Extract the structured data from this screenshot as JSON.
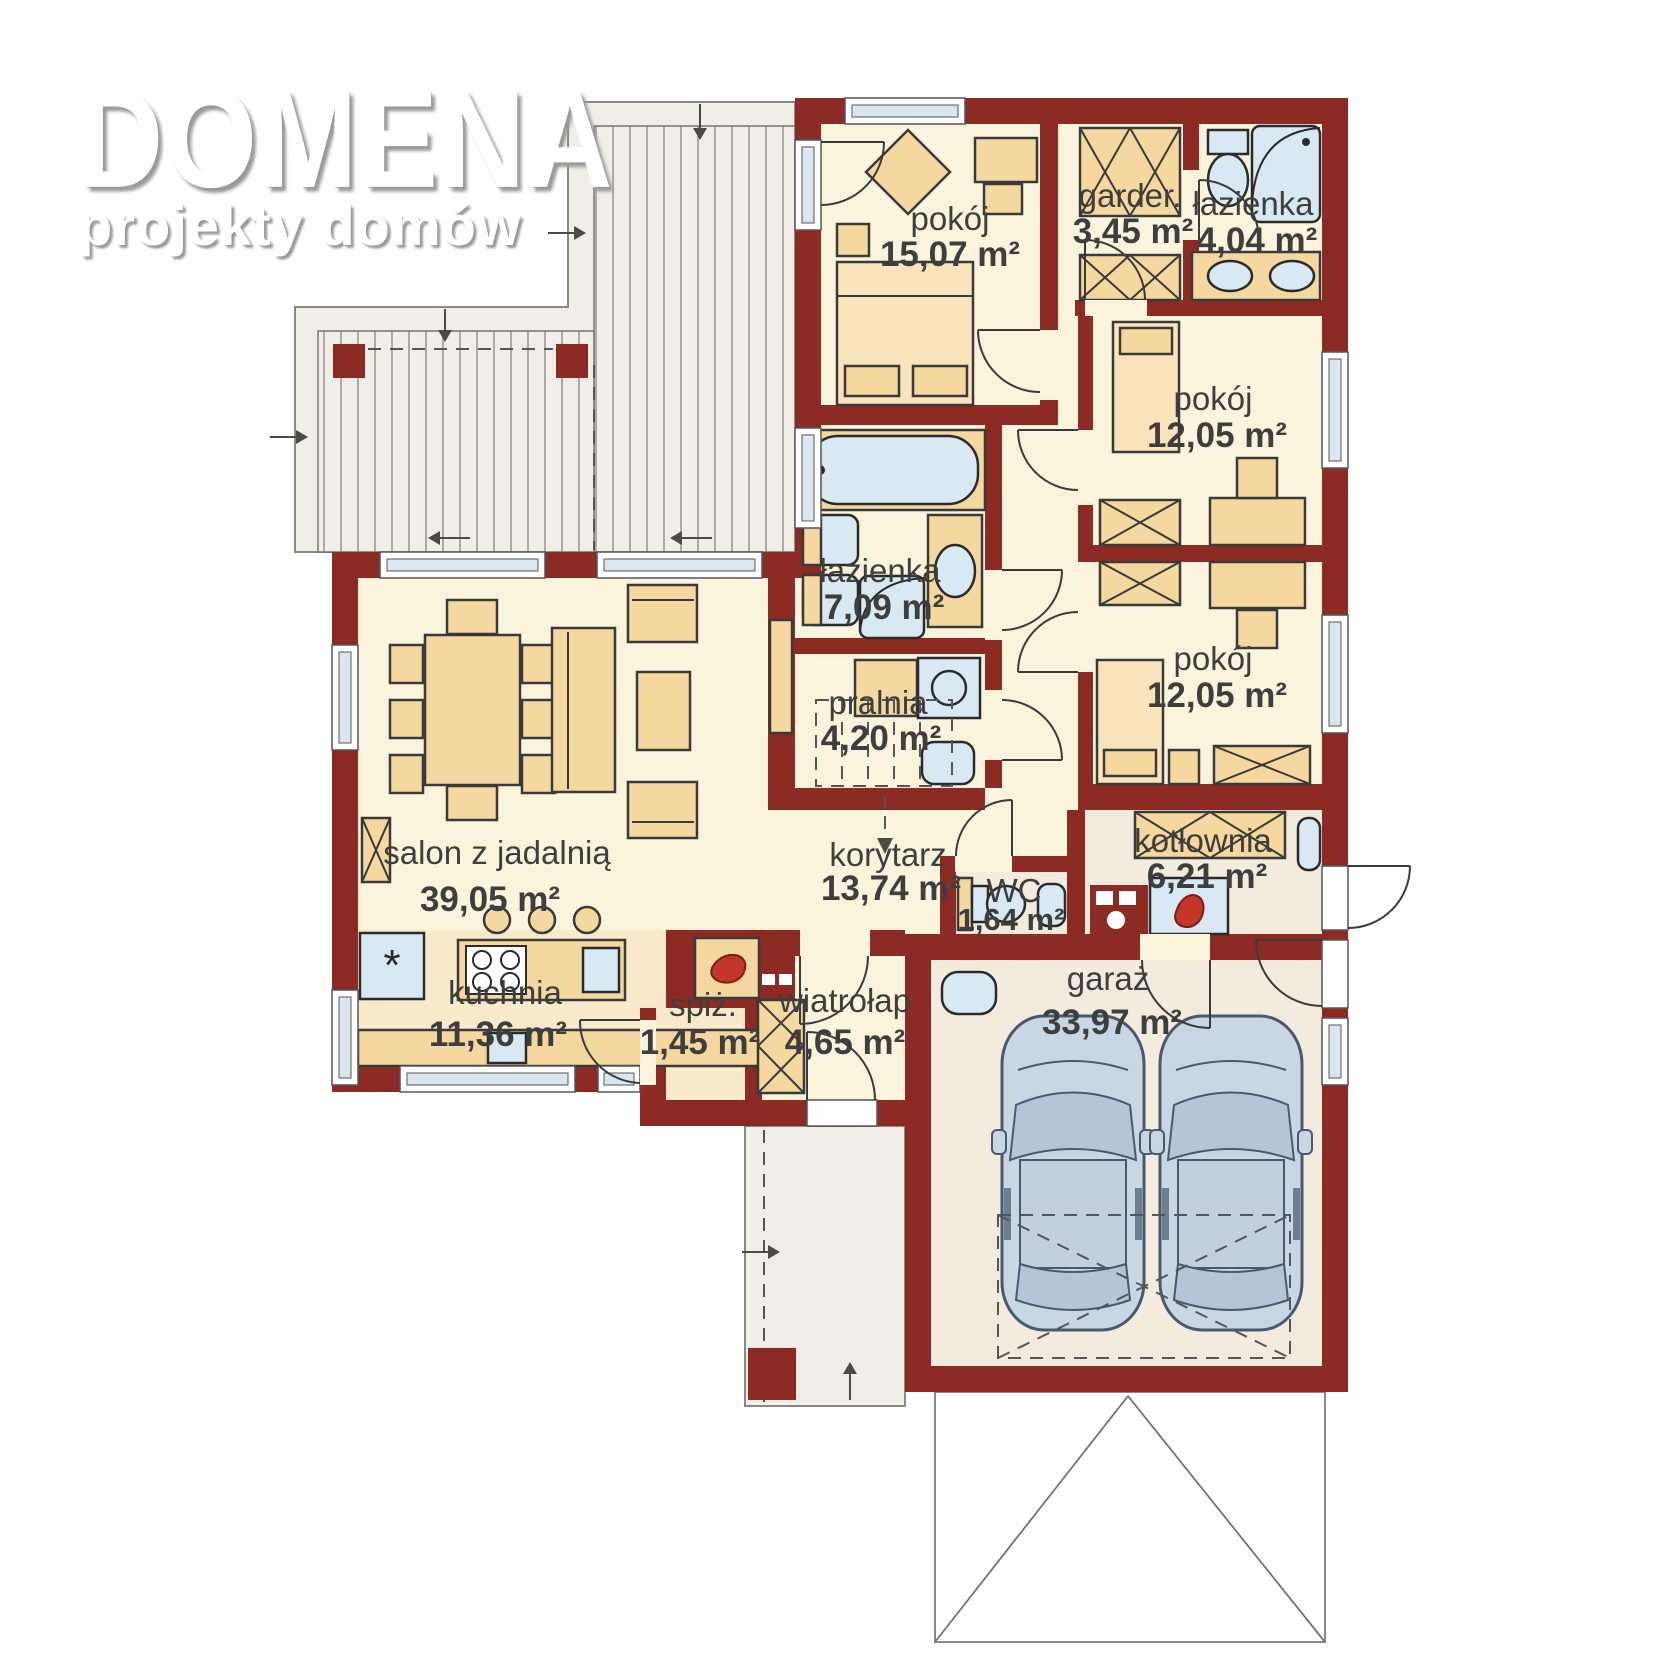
{
  "logo": {
    "title": "DOMENA",
    "subtitle": "projekty domów"
  },
  "plan": {
    "type": "floor-plan",
    "accent_wall_color": "#8C2B23",
    "floor_color": "#FBF4DC",
    "furniture_color": "#F5D7A0",
    "fixture_color": "#D9E9F3"
  },
  "rooms": [
    {
      "id": "pokoj-1",
      "name": "pokój",
      "area": "15,07 m²"
    },
    {
      "id": "garderoba",
      "name": "garder.",
      "area": "3,45 m²"
    },
    {
      "id": "lazienka-mala",
      "name": "łazienka",
      "area": "4,04 m²"
    },
    {
      "id": "pokoj-2",
      "name": "pokój",
      "area": "12,05 m²"
    },
    {
      "id": "lazienka-duza",
      "name": "łazienka",
      "area": "7,09 m²"
    },
    {
      "id": "pralnia",
      "name": "pralnia",
      "area": "4,20 m²"
    },
    {
      "id": "pokoj-3",
      "name": "pokój",
      "area": "12,05 m²"
    },
    {
      "id": "salon",
      "name": "salon z jadalnią",
      "area": "39,05 m²"
    },
    {
      "id": "korytarz",
      "name": "korytarz",
      "area": "13,74 m²"
    },
    {
      "id": "wc",
      "name": "WC",
      "area": "1,64 m²"
    },
    {
      "id": "kotlownia",
      "name": "kotłownia",
      "area": "6,21 m²"
    },
    {
      "id": "kuchnia",
      "name": "kuchnia",
      "area": "11,36 m²"
    },
    {
      "id": "spizarnia",
      "name": "spiż.",
      "area": "1,45 m²"
    },
    {
      "id": "wiatrolap",
      "name": "wiatrołap",
      "area": "4,65 m²"
    },
    {
      "id": "garaz",
      "name": "garaż",
      "area": "33,97 m²"
    }
  ]
}
